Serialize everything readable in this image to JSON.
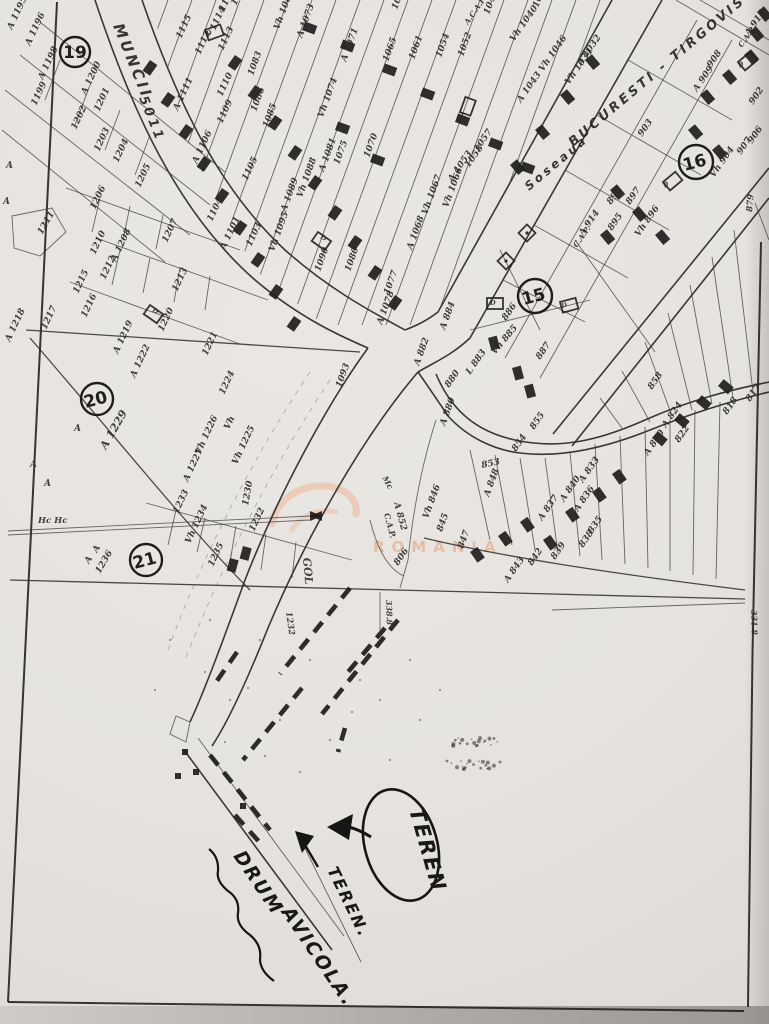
{
  "streets": [
    {
      "t": "MUNCII",
      "x": 113,
      "y": 26,
      "r": 68,
      "s": 15,
      "cls": "street"
    },
    {
      "t": "5011",
      "x": 139,
      "y": 98,
      "r": 68,
      "s": 13,
      "cls": "street"
    },
    {
      "t": "Soseaua",
      "x": 529,
      "y": 191,
      "r": -40,
      "s": 12,
      "cls": "street"
    },
    {
      "t": "BUCURESTI - TIRGOVISTE",
      "x": 573,
      "y": 147,
      "r": -40,
      "s": 13,
      "cls": "street"
    }
  ],
  "zones": [
    {
      "n": "19",
      "x": 75,
      "y": 52,
      "rad": 15,
      "r": 0
    },
    {
      "n": "20",
      "x": 97,
      "y": 399,
      "rad": 16,
      "r": -15
    },
    {
      "n": "21",
      "x": 146,
      "y": 560,
      "rad": 16,
      "r": -15
    },
    {
      "n": "15",
      "x": 535,
      "y": 296,
      "rad": 17,
      "r": -15
    },
    {
      "n": "16",
      "x": 696,
      "y": 162,
      "rad": 17,
      "r": -15
    }
  ],
  "labels": [
    {
      "t": "A 1195",
      "x": 12,
      "y": 30,
      "r": -65
    },
    {
      "t": "A 1196",
      "x": 30,
      "y": 46,
      "r": -65
    },
    {
      "t": "A 1198",
      "x": 43,
      "y": 80,
      "r": -65
    },
    {
      "t": "1199",
      "x": 36,
      "y": 106,
      "r": -65
    },
    {
      "t": "A 1200",
      "x": 86,
      "y": 95,
      "r": -65
    },
    {
      "t": "1201",
      "x": 99,
      "y": 112,
      "r": -65
    },
    {
      "t": "1202",
      "x": 76,
      "y": 130,
      "r": -65
    },
    {
      "t": "1203",
      "x": 99,
      "y": 152,
      "r": -65
    },
    {
      "t": "1204",
      "x": 118,
      "y": 163,
      "r": -65
    },
    {
      "t": "1205",
      "x": 140,
      "y": 188,
      "r": -65
    },
    {
      "t": "1206",
      "x": 95,
      "y": 210,
      "r": -65
    },
    {
      "t": "1211",
      "x": 42,
      "y": 235,
      "r": -60
    },
    {
      "t": "1207",
      "x": 167,
      "y": 243,
      "r": -65
    },
    {
      "t": "A 1208",
      "x": 116,
      "y": 262,
      "r": -65
    },
    {
      "t": "1210",
      "x": 95,
      "y": 255,
      "r": -65
    },
    {
      "t": "1212",
      "x": 105,
      "y": 280,
      "r": -65
    },
    {
      "t": "1215",
      "x": 78,
      "y": 294,
      "r": -65
    },
    {
      "t": "1216",
      "x": 86,
      "y": 318,
      "r": -65
    },
    {
      "t": "1213",
      "x": 177,
      "y": 292,
      "r": -65
    },
    {
      "t": "1220",
      "x": 163,
      "y": 332,
      "r": -65
    },
    {
      "t": "1221",
      "x": 207,
      "y": 356,
      "r": -65
    },
    {
      "t": "A 1219",
      "x": 118,
      "y": 354,
      "r": -65
    },
    {
      "t": "1217",
      "x": 46,
      "y": 330,
      "r": -65
    },
    {
      "t": "A 1218",
      "x": 10,
      "y": 342,
      "r": -65
    },
    {
      "t": "A 1222",
      "x": 135,
      "y": 378,
      "r": -65
    },
    {
      "t": "1224",
      "x": 224,
      "y": 395,
      "r": -65
    },
    {
      "t": "Vh",
      "x": 229,
      "y": 430,
      "r": -65
    },
    {
      "t": "Vh 1225",
      "x": 237,
      "y": 465,
      "r": -65
    },
    {
      "t": "Vh 1226",
      "x": 200,
      "y": 455,
      "r": -65
    },
    {
      "t": "A 1227",
      "x": 188,
      "y": 482,
      "r": -65
    },
    {
      "t": "A 1229",
      "x": 106,
      "y": 450,
      "r": -60,
      "s": 11
    },
    {
      "t": "A",
      "x": 74,
      "y": 431,
      "r": 0
    },
    {
      "t": "A",
      "x": 30,
      "y": 467,
      "r": 0
    },
    {
      "t": "A",
      "x": 44,
      "y": 486,
      "r": 0
    },
    {
      "t": "Hc Hc",
      "x": 38,
      "y": 523,
      "r": 0,
      "s": 8.5
    },
    {
      "t": "A",
      "x": 97,
      "y": 553,
      "r": -60
    },
    {
      "t": "A",
      "x": 89,
      "y": 564,
      "r": -60
    },
    {
      "t": "1236",
      "x": 100,
      "y": 574,
      "r": -60
    },
    {
      "t": "1233",
      "x": 178,
      "y": 514,
      "r": -65
    },
    {
      "t": "Vh 1234",
      "x": 190,
      "y": 544,
      "r": -65
    },
    {
      "t": "1235",
      "x": 213,
      "y": 567,
      "r": -65
    },
    {
      "t": "1232",
      "x": 254,
      "y": 532,
      "r": -65
    },
    {
      "t": "1230",
      "x": 248,
      "y": 506,
      "r": -80
    },
    {
      "t": "1232",
      "x": 286,
      "y": 612,
      "r": 82,
      "cls": "vert",
      "s": 8.5
    },
    {
      "t": "A 1101",
      "x": 225,
      "y": 250,
      "r": -65
    },
    {
      "t": "1104",
      "x": 212,
      "y": 222,
      "r": -65
    },
    {
      "t": "1103",
      "x": 251,
      "y": 247,
      "r": -65
    },
    {
      "t": "1105",
      "x": 247,
      "y": 181,
      "r": -65
    },
    {
      "t": "A 1106",
      "x": 197,
      "y": 164,
      "r": -65
    },
    {
      "t": "1109",
      "x": 222,
      "y": 124,
      "r": -65
    },
    {
      "t": "1110",
      "x": 222,
      "y": 97,
      "r": -65
    },
    {
      "t": "A 1111",
      "x": 178,
      "y": 111,
      "r": -65
    },
    {
      "t": "1113",
      "x": 223,
      "y": 51,
      "r": -65
    },
    {
      "t": "1112",
      "x": 200,
      "y": 55,
      "r": -65
    },
    {
      "t": "1114",
      "x": 215,
      "y": 31,
      "r": -65
    },
    {
      "t": "1115",
      "x": 181,
      "y": 39,
      "r": -65
    },
    {
      "t": "1118",
      "x": 224,
      "y": 12,
      "r": -65
    },
    {
      "t": "1117",
      "x": 236,
      "y": 6,
      "r": -65
    },
    {
      "t": "Vh 1082",
      "x": 279,
      "y": 30,
      "r": -70
    },
    {
      "t": "A 1073",
      "x": 302,
      "y": 38,
      "r": -70
    },
    {
      "t": "A 1071",
      "x": 346,
      "y": 62,
      "r": -70
    },
    {
      "t": "1083",
      "x": 253,
      "y": 76,
      "r": -70
    },
    {
      "t": "1085",
      "x": 268,
      "y": 128,
      "r": -70
    },
    {
      "t": "1086",
      "x": 256,
      "y": 112,
      "r": -70
    },
    {
      "t": "Vh 1074",
      "x": 323,
      "y": 118,
      "r": -70
    },
    {
      "t": "1075",
      "x": 339,
      "y": 165,
      "r": -70
    },
    {
      "t": "1070",
      "x": 369,
      "y": 158,
      "r": -70
    },
    {
      "t": "A 1081",
      "x": 324,
      "y": 172,
      "r": -70
    },
    {
      "t": "Vh 1088",
      "x": 302,
      "y": 198,
      "r": -70
    },
    {
      "t": "A 1089",
      "x": 286,
      "y": 212,
      "r": -70
    },
    {
      "t": "Vh 1095",
      "x": 274,
      "y": 252,
      "r": -70
    },
    {
      "t": "1090",
      "x": 320,
      "y": 272,
      "r": -70
    },
    {
      "t": "1080",
      "x": 350,
      "y": 272,
      "r": -70
    },
    {
      "t": "1093",
      "x": 341,
      "y": 388,
      "r": -70
    },
    {
      "t": "1077",
      "x": 389,
      "y": 295,
      "r": -70
    },
    {
      "t": "A 1078",
      "x": 382,
      "y": 325,
      "r": -70
    },
    {
      "t": "A 1068",
      "x": 412,
      "y": 250,
      "r": -70
    },
    {
      "t": "Vh 1067",
      "x": 427,
      "y": 215,
      "r": -70
    },
    {
      "t": "Vh 1066",
      "x": 448,
      "y": 208,
      "r": -70
    },
    {
      "t": "1062",
      "x": 397,
      "y": 10,
      "r": -70
    },
    {
      "t": "1065",
      "x": 388,
      "y": 62,
      "r": -70
    },
    {
      "t": "1061",
      "x": 414,
      "y": 60,
      "r": -70
    },
    {
      "t": "1054",
      "x": 441,
      "y": 58,
      "r": -70
    },
    {
      "t": "1052",
      "x": 463,
      "y": 57,
      "r": -70
    },
    {
      "t": "A.C.A.P",
      "x": 468,
      "y": 25,
      "r": -55,
      "s": 7.5
    },
    {
      "t": "1047",
      "x": 489,
      "y": 15,
      "r": -70
    },
    {
      "t": "1039",
      "x": 538,
      "y": 8,
      "r": -70
    },
    {
      "t": "Vh 1040",
      "x": 514,
      "y": 42,
      "r": -55
    },
    {
      "t": "A 1043",
      "x": 521,
      "y": 103,
      "r": -55
    },
    {
      "t": "Vh 1046",
      "x": 543,
      "y": 72,
      "r": -55
    },
    {
      "t": "A 1032",
      "x": 581,
      "y": 66,
      "r": -55
    },
    {
      "t": "Vh 1034",
      "x": 569,
      "y": 85,
      "r": -55
    },
    {
      "t": "1057",
      "x": 478,
      "y": 152,
      "r": -55
    },
    {
      "t": "1058",
      "x": 469,
      "y": 168,
      "r": -55
    },
    {
      "t": "A 1053",
      "x": 452,
      "y": 182,
      "r": -55
    },
    {
      "t": "A 915",
      "x": 749,
      "y": 36,
      "r": -55
    },
    {
      "t": "C.A.P.",
      "x": 742,
      "y": 48,
      "r": -55,
      "s": 7.5
    },
    {
      "t": "908",
      "x": 711,
      "y": 68,
      "r": -55
    },
    {
      "t": "A 909",
      "x": 697,
      "y": 92,
      "r": -55
    },
    {
      "t": "902",
      "x": 753,
      "y": 105,
      "r": -55
    },
    {
      "t": "906",
      "x": 752,
      "y": 144,
      "r": -55
    },
    {
      "t": "907",
      "x": 741,
      "y": 155,
      "r": -55
    },
    {
      "t": "Vh 904",
      "x": 714,
      "y": 178,
      "r": -55
    },
    {
      "t": "903",
      "x": 642,
      "y": 137,
      "r": -55
    },
    {
      "t": "898",
      "x": 611,
      "y": 205,
      "r": -55
    },
    {
      "t": "897",
      "x": 630,
      "y": 205,
      "r": -55
    },
    {
      "t": "895",
      "x": 612,
      "y": 231,
      "r": -55
    },
    {
      "t": "Vh 896",
      "x": 639,
      "y": 237,
      "r": -55
    },
    {
      "t": "879",
      "x": 752,
      "y": 212,
      "r": -85,
      "s": 8.5
    },
    {
      "t": "A 914",
      "x": 583,
      "y": 236,
      "r": -55
    },
    {
      "t": "C.A.P.",
      "x": 577,
      "y": 248,
      "r": -55,
      "s": 7.5
    },
    {
      "t": "A 884",
      "x": 445,
      "y": 330,
      "r": -70
    },
    {
      "t": "886",
      "x": 506,
      "y": 321,
      "r": -55
    },
    {
      "t": "Vh 885",
      "x": 495,
      "y": 355,
      "r": -50
    },
    {
      "t": "A 882",
      "x": 419,
      "y": 366,
      "r": -70
    },
    {
      "t": "L 883",
      "x": 470,
      "y": 375,
      "r": -55
    },
    {
      "t": "880",
      "x": 449,
      "y": 388,
      "r": -55
    },
    {
      "t": "887",
      "x": 540,
      "y": 360,
      "r": -55
    },
    {
      "t": "A 880",
      "x": 445,
      "y": 426,
      "r": -70
    },
    {
      "t": "Mc",
      "x": 382,
      "y": 478,
      "r": 60,
      "s": 8
    },
    {
      "t": "A 852",
      "x": 394,
      "y": 503,
      "r": 75,
      "s": 9
    },
    {
      "t": "C.A.P.",
      "x": 384,
      "y": 514,
      "r": 75,
      "s": 8
    },
    {
      "t": "806",
      "x": 398,
      "y": 566,
      "r": -55
    },
    {
      "t": "GOL",
      "x": 303,
      "y": 558,
      "r": 85,
      "cls": "vert",
      "s": 11
    },
    {
      "t": "338.8",
      "x": 386,
      "y": 600,
      "r": 88,
      "cls": "vert",
      "s": 8
    },
    {
      "t": "331.8",
      "x": 751,
      "y": 610,
      "r": 88,
      "cls": "vert",
      "s": 8
    },
    {
      "t": "853",
      "x": 482,
      "y": 468,
      "r": -12
    },
    {
      "t": "854",
      "x": 516,
      "y": 452,
      "r": -55
    },
    {
      "t": "855",
      "x": 534,
      "y": 430,
      "r": -55
    },
    {
      "t": "A 848",
      "x": 489,
      "y": 497,
      "r": -70
    },
    {
      "t": "845",
      "x": 442,
      "y": 532,
      "r": -70
    },
    {
      "t": "847",
      "x": 463,
      "y": 549,
      "r": -70
    },
    {
      "t": "Vh 846",
      "x": 428,
      "y": 519,
      "r": -70
    },
    {
      "t": "A 843",
      "x": 508,
      "y": 583,
      "r": -55
    },
    {
      "t": "842",
      "x": 532,
      "y": 566,
      "r": -55
    },
    {
      "t": "839",
      "x": 555,
      "y": 560,
      "r": -55
    },
    {
      "t": "838",
      "x": 583,
      "y": 548,
      "r": -55
    },
    {
      "t": "835",
      "x": 592,
      "y": 534,
      "r": -55
    },
    {
      "t": "A 837",
      "x": 542,
      "y": 521,
      "r": -55
    },
    {
      "t": "A 836",
      "x": 578,
      "y": 512,
      "r": -55
    },
    {
      "t": "A 840",
      "x": 564,
      "y": 502,
      "r": -55
    },
    {
      "t": "A 833",
      "x": 583,
      "y": 483,
      "r": -55
    },
    {
      "t": "A 830",
      "x": 648,
      "y": 456,
      "r": -55
    },
    {
      "t": "858",
      "x": 652,
      "y": 390,
      "r": -55
    },
    {
      "t": "A 824",
      "x": 666,
      "y": 428,
      "r": -55
    },
    {
      "t": "822",
      "x": 679,
      "y": 443,
      "r": -55
    },
    {
      "t": "817",
      "x": 750,
      "y": 402,
      "r": -55
    },
    {
      "t": "818",
      "x": 727,
      "y": 415,
      "r": -55
    },
    {
      "t": "A",
      "x": 6,
      "y": 168,
      "r": 0
    },
    {
      "t": "A",
      "x": 3,
      "y": 204,
      "r": 0
    }
  ],
  "building_marks": [
    {
      "t": "D",
      "x": 207,
      "y": 36,
      "r": -20
    },
    {
      "t": "D",
      "x": 152,
      "y": 311,
      "r": 35
    },
    {
      "t": "D",
      "x": 462,
      "y": 118,
      "r": -70
    },
    {
      "t": "D",
      "x": 490,
      "y": 305,
      "r": 0
    },
    {
      "t": "D",
      "x": 320,
      "y": 238,
      "r": 35
    },
    {
      "t": "D",
      "x": 665,
      "y": 188,
      "r": -40
    },
    {
      "t": "D",
      "x": 740,
      "y": 68,
      "r": -40
    },
    {
      "t": "D",
      "x": 562,
      "y": 308,
      "r": -15
    }
  ],
  "annotations": {
    "bubble_text": "TEREN",
    "line_label": "TEREN.",
    "road_label_1": "DRUM",
    "road_label_2": "AVICOLA."
  },
  "watermark": {
    "text": "ROMANIA",
    "color": "#e5b496",
    "arc_color": "#ecc3aa"
  }
}
